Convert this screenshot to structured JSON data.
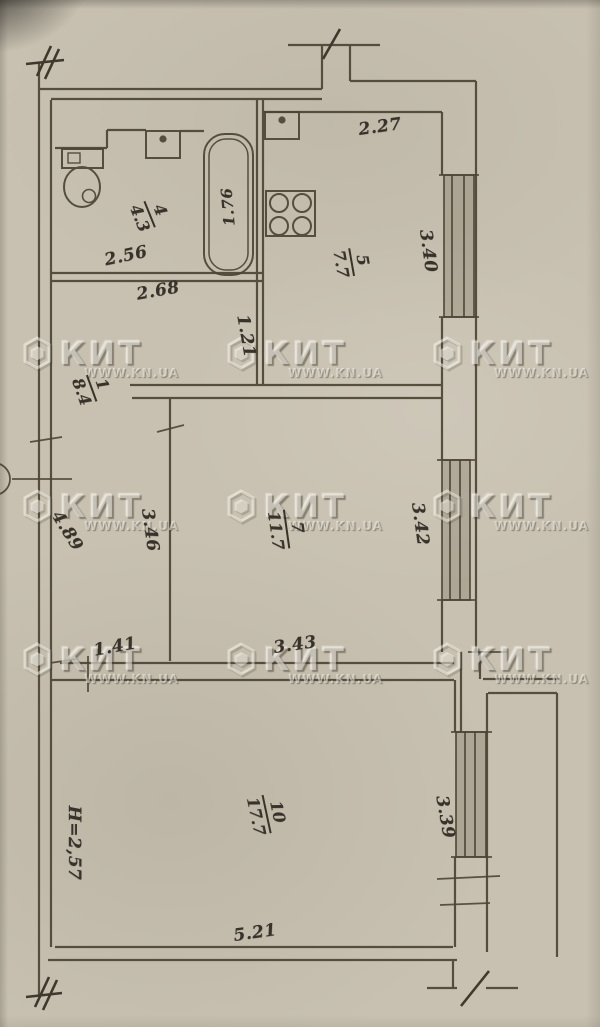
{
  "watermark": {
    "brand": "КИТ",
    "url": "WWW.KN.UA"
  },
  "rooms": {
    "bathroom": {
      "number": "4",
      "area": "4.3"
    },
    "kitchen": {
      "number": "5",
      "area": "7.7"
    },
    "hall": {
      "number": "1",
      "area": "8.4"
    },
    "living": {
      "number": "7",
      "area": "11.7"
    },
    "main": {
      "number": "10",
      "area": "17.7"
    }
  },
  "dims": {
    "kitchen_top": "2.27",
    "kitchen_window": "3.40",
    "tub": "1.76",
    "bath_inner": "2.56",
    "bath_outer": "2.68",
    "kitchen_wall": "1.21",
    "hall_left": "4.89",
    "living_left": "3.46",
    "living_window": "3.42",
    "corridor_width": "1.41",
    "living_width": "3.43",
    "ceiling_height": "H=2,57",
    "main_window": "3.39",
    "main_width": "5.21"
  }
}
